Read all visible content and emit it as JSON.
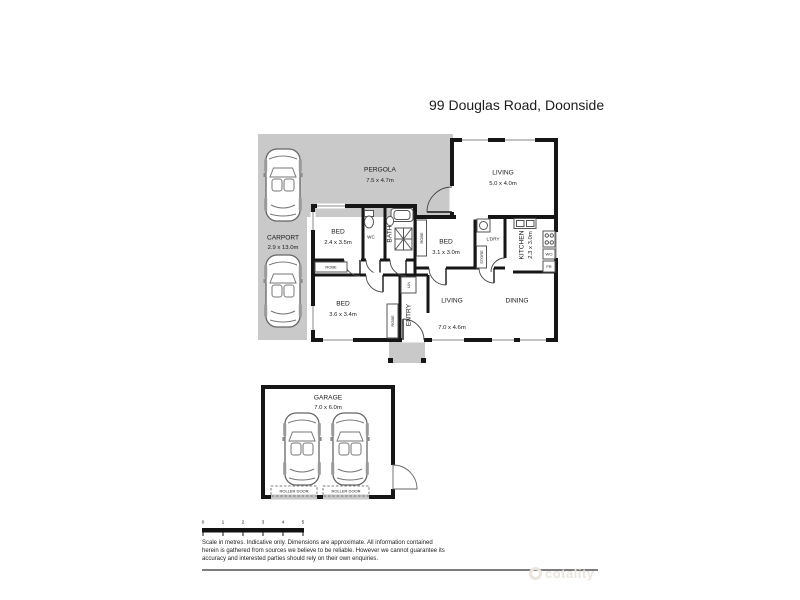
{
  "page": {
    "title": "99 Douglas Road, Doonside",
    "watermark": "cotality"
  },
  "rooms": {
    "pergola": {
      "name": "PERGOLA",
      "dims": "7.5 x 4.7m"
    },
    "carport": {
      "name": "CARPORT",
      "dims": "2.9 x 13.0m"
    },
    "living_upper": {
      "name": "LIVING",
      "dims": "5.0 x 4.0m"
    },
    "bed_front": {
      "name": "BED",
      "dims": "2.4 x 3.5m"
    },
    "bed_middle": {
      "name": "BED",
      "dims": "3.1 x 3.0m"
    },
    "bed_rear": {
      "name": "BED",
      "dims": "3.6 x 3.4m"
    },
    "living_main": {
      "name": "LIVING",
      "dims": "7.0 x 4.6m"
    },
    "dining": {
      "name": "DINING"
    },
    "kitchen": {
      "name": "KITCHEN",
      "dims": "2.3 x 3.0m"
    },
    "laundry": {
      "name": "L'DRY"
    },
    "bath": {
      "name": "BATH"
    },
    "wc": {
      "name": "WC"
    },
    "entry": {
      "name": "ENTRY"
    },
    "garage": {
      "name": "GARAGE",
      "dims": "7.0 x 6.0m"
    }
  },
  "fixtures": {
    "robe": "ROBE",
    "store": "STORE",
    "linen": "LIN",
    "wall_oven": "WO",
    "fridge": "FR",
    "roller_door": "ROLLER DOOR"
  },
  "scale_bar": {
    "ticks": [
      "0",
      "1",
      "2",
      "3",
      "4",
      "5"
    ]
  },
  "disclaimer": "Scale in metres. Indicative only. Dimensions are approximate. All information contained\nherein is gathered from sources we believe to be reliable. However we cannot guarantee its\naccuracy and interested parties should rely on their own enquiries."
}
